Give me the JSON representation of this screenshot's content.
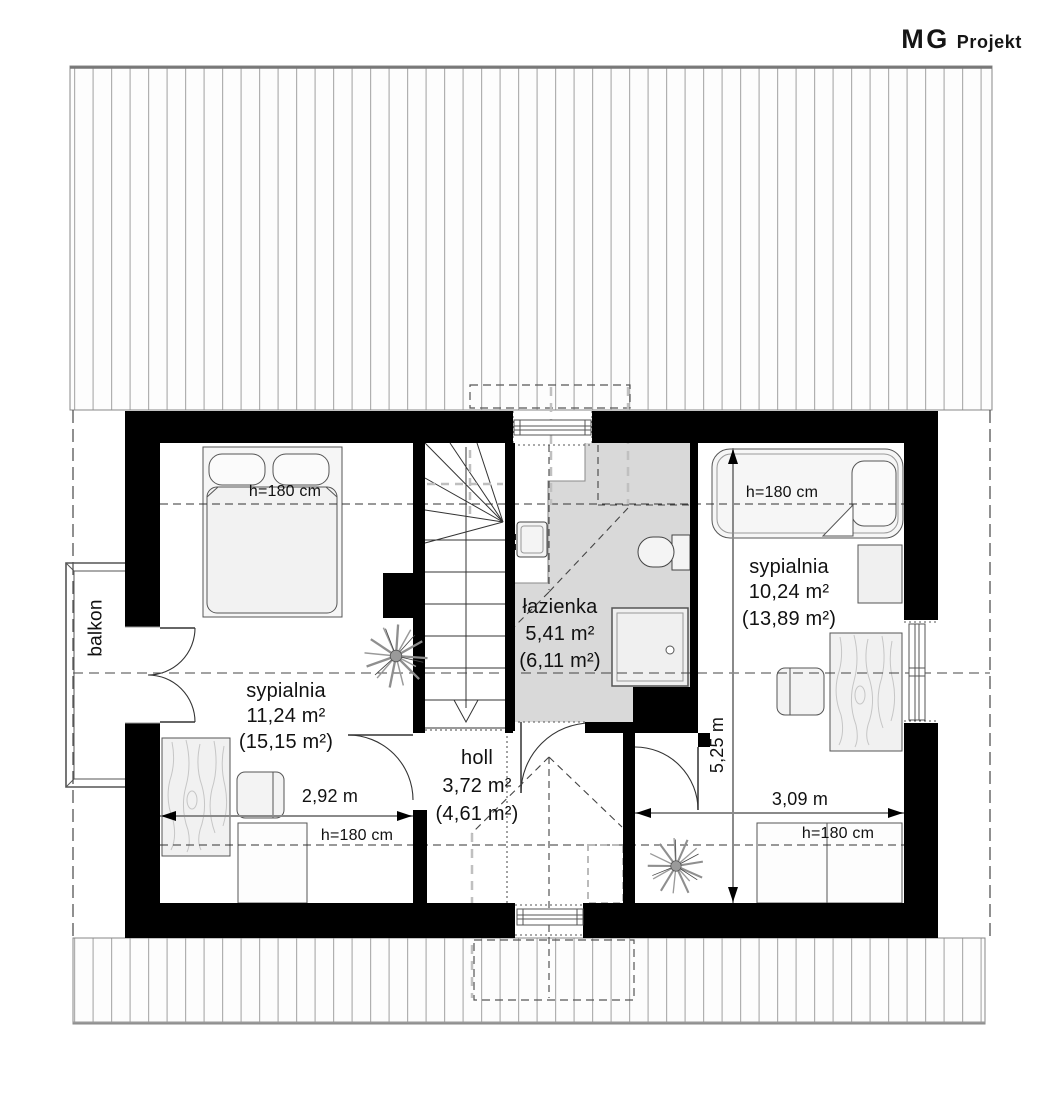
{
  "brand": {
    "name_main": "MG",
    "name_sub": "Projekt"
  },
  "floor_plan": {
    "rooms": {
      "bedroom_left": {
        "name": "sypialnia",
        "area": "11,24 m²",
        "area_gross": "(15,15 m²)"
      },
      "bathroom": {
        "name": "łazienka",
        "area": "5,41 m²",
        "area_gross": "(6,11 m²)"
      },
      "hall": {
        "name": "holl",
        "area": "3,72 m²",
        "area_gross": "(4,61 m²)"
      },
      "bedroom_right": {
        "name": "sypialnia",
        "area": "10,24 m²",
        "area_gross": "(13,89 m²)"
      },
      "balcony": {
        "name": "balkon"
      }
    },
    "dimensions": {
      "bedroom_left_width": "2,92 m",
      "bedroom_right_width": "3,09 m",
      "plan_depth": "5,25 m"
    },
    "ceiling_height_label": "h=180 cm",
    "colors": {
      "wall": "#000000",
      "bathroom_floor": "#d9d9d9",
      "roof_hatch_line": "#b0b0b0",
      "dash_line": "#444444",
      "dimension_line": "#8a8a8a"
    }
  }
}
